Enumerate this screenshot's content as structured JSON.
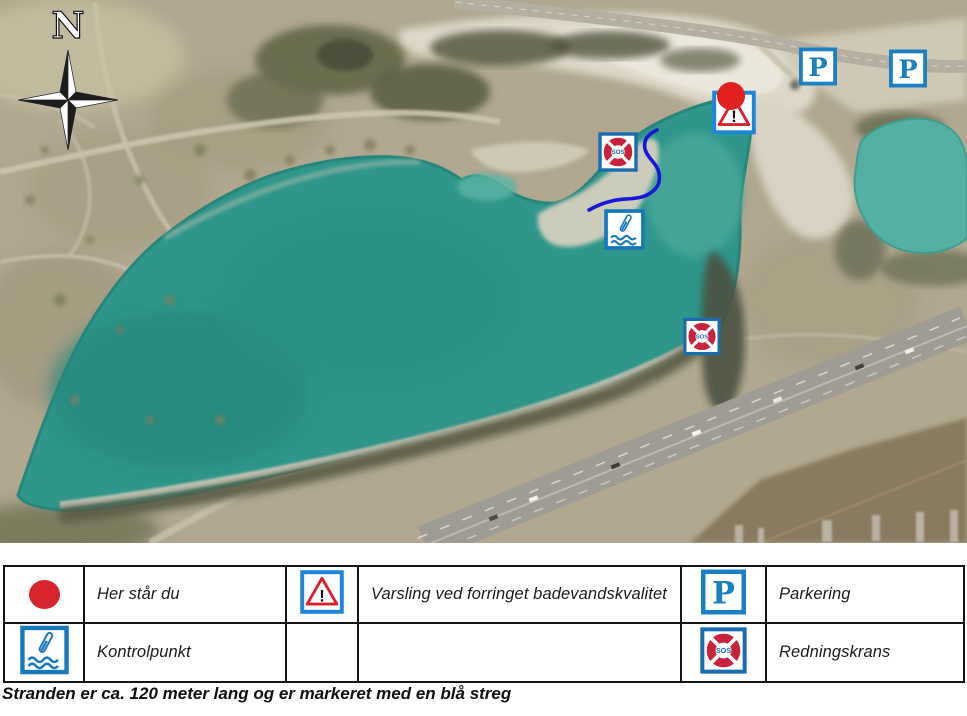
{
  "map": {
    "compass_label": "N",
    "markers": {
      "parking_letter": "P",
      "sos_label": "SOS",
      "warning_mark": "!"
    }
  },
  "colors": {
    "signage_blue": "#1b7fc4",
    "warning_border_blue": "#1e86d8",
    "warning_triangle_red": "#d8232a",
    "lifebuoy_red": "#c8223c",
    "you_are_here_red": "#e0211f",
    "beach_line_blue": "#1717d6",
    "lake_teal": "#2e968b",
    "small_lake_teal": "#54b0a4"
  },
  "legend": {
    "rows": [
      {
        "cells": [
          {
            "icon": "her-star-du-dot",
            "label": "Her står du"
          },
          {
            "icon": "warning-triangle",
            "label": "Varsling ved forringet badevandskvalitet"
          },
          {
            "icon": "parking-sign",
            "label": "Parkering"
          }
        ]
      },
      {
        "cells": [
          {
            "icon": "kontrolpunkt-sign",
            "label": "Kontrolpunkt"
          },
          {
            "icon": "",
            "label": ""
          },
          {
            "icon": "redningskrans-sign",
            "label": "Redningskrans"
          }
        ]
      }
    ]
  },
  "caption": "Stranden er ca. 120 meter lang og er markeret med en blå streg"
}
